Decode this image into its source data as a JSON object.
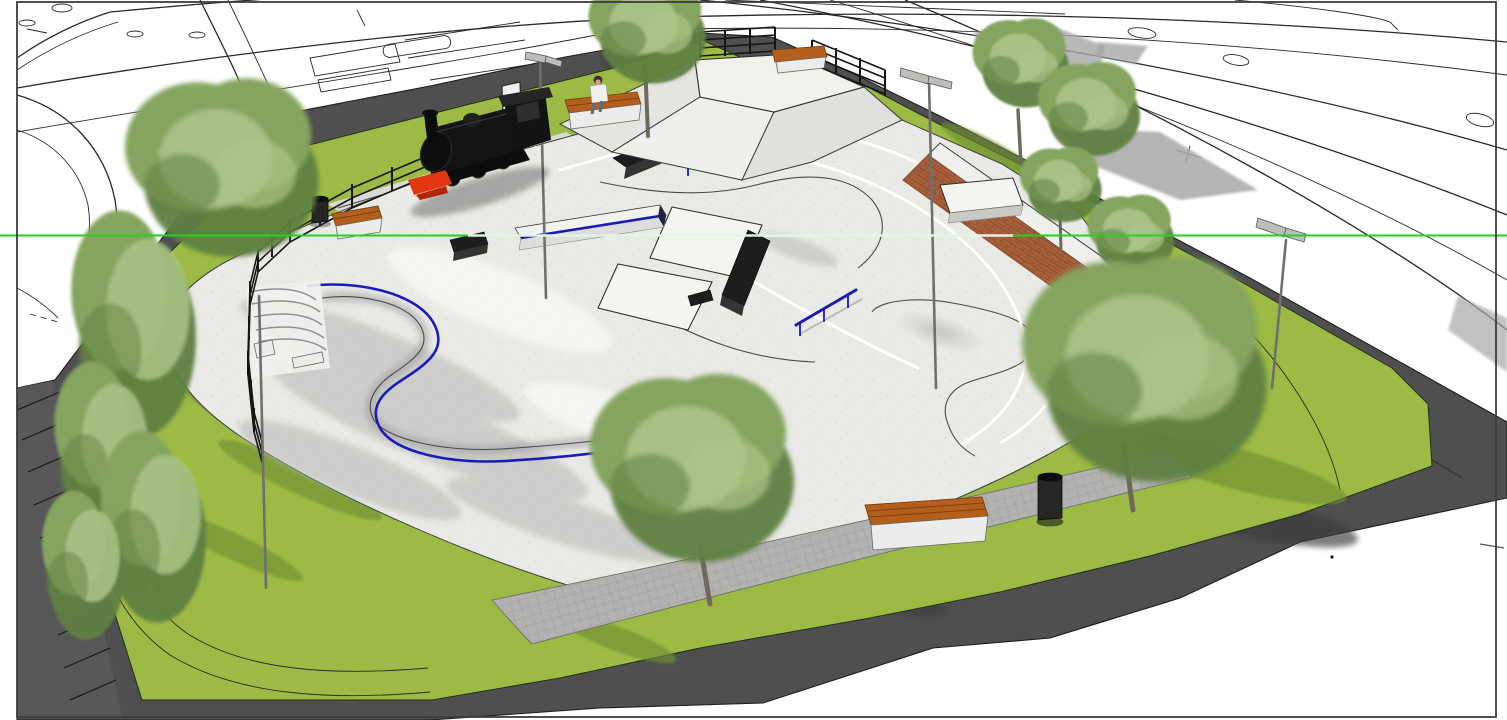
{
  "meta": {
    "title": "Skatepark concept - aerial 3D render with display steam locomotive",
    "render_style": "SketchUp-style architectural visualization over road linework",
    "canvas": {
      "width": 1507,
      "height": 720
    }
  },
  "colors": {
    "background": "#ffffff",
    "frame": "#3c3c3c",
    "line_art": "#2a2a2a",
    "axis_green": "#1fd41f",
    "axis_overlay": "#f4f6f1",
    "asphalt": "#4f4f4f",
    "asphalt_hatch": "#585858",
    "asphalt_shadow": "#3a3a3a",
    "road_shadow": "#a7a7a7",
    "grass": "#9dbb44",
    "grass_shadow": "#6f8f33",
    "concrete": "#e9e9e6",
    "concrete_shadow": "#b7b7b5",
    "concrete_bright": "#f8f8f6",
    "paver": "#b3b2b0",
    "paver_line": "#9a9998",
    "slab": "#d9d9d6",
    "steel_blue": "#1a1ab8",
    "ledge_dark": "#1d1d1d",
    "ledge_face": "#343434",
    "brick": "#a85f3b",
    "brick_line": "#8a4a2c",
    "wood": "#b55f1d",
    "wood_line": "#7d3f12",
    "bench_base": "#ececea",
    "train_body": "#141414",
    "train_red": "#e23511",
    "tree_light": "#a9c487",
    "tree_mid": "#85a45f",
    "tree_dark": "#5f7f42",
    "trunk": "#6f685c",
    "metal": "#6f6f6f",
    "fence": "#161616",
    "person_shirt": "#f0f0ee",
    "person_skin": "#caa389",
    "person_hair": "#3a3229"
  },
  "scene": {
    "site": "neighbourhood skatepark on a corner plot ringed by roads",
    "ground": [
      "perimeter asphalt road",
      "hatched crossing zone",
      "lawn ring",
      "concrete skate plaza",
      "paved pedestrian walkways",
      "locomotive track slab"
    ],
    "skate_features": [
      "kidney bowl with blue steel coping",
      "amphitheatre seating steps",
      "central funbox with twin platforms",
      "black grind ledges",
      "white ledge with blue steel edge",
      "blue flat rail",
      "blue sloped handrail",
      "pyramid bank with fenced platform",
      "long brick bank",
      "white manual pad",
      "organic concrete mound"
    ],
    "furniture": [
      "timber benches on concrete bases",
      "litter bins",
      "street lamp posts",
      "information sign",
      "black railing fence"
    ],
    "context": [
      "surrounding roads as CAD linework",
      "traffic islands",
      "crossing dashes",
      "grey cast shadows",
      "green modelling axis line",
      "sitting person",
      "black steam locomotive monument",
      "trees"
    ],
    "counts": {
      "trees": 12,
      "benches": 5,
      "litter_bins": 3,
      "lamp_posts": 4,
      "people": 1,
      "locomotives": 1
    }
  }
}
